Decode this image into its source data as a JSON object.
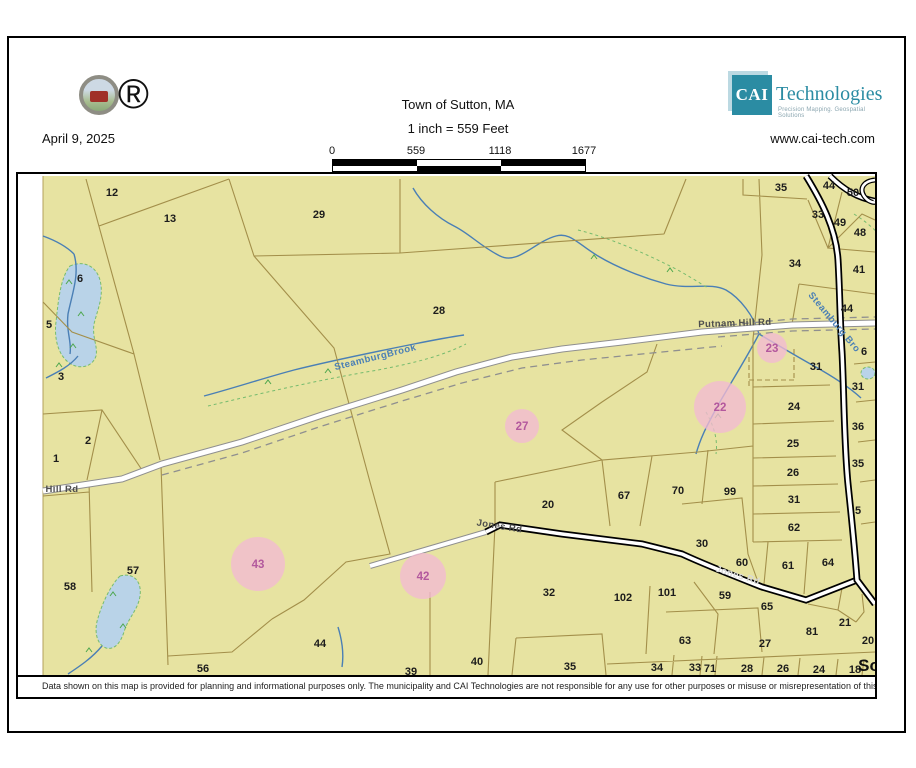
{
  "header": {
    "date": "April 9, 2025",
    "registered_mark": "®",
    "title": "Town of Sutton, MA",
    "scale_text": "1 inch = 559 Feet",
    "scale_ticks": [
      "0",
      "559",
      "1118",
      "1677"
    ],
    "brand": {
      "abbr": "CAI",
      "name": "Technologies",
      "tagline": "Precision Mapping. Geospatial Solutions",
      "website": "www.cai-tech.com"
    }
  },
  "map": {
    "disclaimer": "Data shown on this map is provided for planning and informational purposes only. The municipality and CAI Technologies are not responsible for any use for other purposes or misuse or misrepresentation of this map.",
    "colors": {
      "land": "#e7e3a1",
      "parcel_line": "#a38f4a",
      "water_fill": "#b9d3e8",
      "water_line": "#4a7fb5",
      "wetland_green": "#76bb6e",
      "highlight_pink": "#f2bad4",
      "highlight_text": "#b3589d",
      "brand_teal": "#2b8ca3"
    },
    "parcel_labels": [
      {
        "n": "12",
        "x": 94,
        "y": 18
      },
      {
        "n": "13",
        "x": 152,
        "y": 44
      },
      {
        "n": "29",
        "x": 301,
        "y": 40
      },
      {
        "n": "28",
        "x": 421,
        "y": 136
      },
      {
        "n": "6",
        "x": 62,
        "y": 104
      },
      {
        "n": "5",
        "x": 31,
        "y": 150
      },
      {
        "n": "3",
        "x": 43,
        "y": 202
      },
      {
        "n": "2",
        "x": 70,
        "y": 266
      },
      {
        "n": "1",
        "x": 38,
        "y": 284
      },
      {
        "n": "58",
        "x": 52,
        "y": 412
      },
      {
        "n": "57",
        "x": 115,
        "y": 396
      },
      {
        "n": "56",
        "x": 185,
        "y": 494
      },
      {
        "n": "44",
        "x": 302,
        "y": 469
      },
      {
        "n": "39",
        "x": 393,
        "y": 497
      },
      {
        "n": "40",
        "x": 459,
        "y": 487
      },
      {
        "n": "35",
        "x": 552,
        "y": 492
      },
      {
        "n": "32",
        "x": 531,
        "y": 418
      },
      {
        "n": "20",
        "x": 530,
        "y": 330
      },
      {
        "n": "67",
        "x": 606,
        "y": 321
      },
      {
        "n": "70",
        "x": 660,
        "y": 316
      },
      {
        "n": "99",
        "x": 712,
        "y": 317
      },
      {
        "n": "30",
        "x": 684,
        "y": 369
      },
      {
        "n": "60",
        "x": 724,
        "y": 388
      },
      {
        "n": "61",
        "x": 770,
        "y": 391
      },
      {
        "n": "64",
        "x": 810,
        "y": 388
      },
      {
        "n": "102",
        "x": 605,
        "y": 423
      },
      {
        "n": "101",
        "x": 649,
        "y": 418
      },
      {
        "n": "59",
        "x": 707,
        "y": 421
      },
      {
        "n": "65",
        "x": 749,
        "y": 432
      },
      {
        "n": "63",
        "x": 667,
        "y": 466
      },
      {
        "n": "27",
        "x": 747,
        "y": 469
      },
      {
        "n": "81",
        "x": 794,
        "y": 457
      },
      {
        "n": "21",
        "x": 827,
        "y": 448
      },
      {
        "n": "20",
        "x": 850,
        "y": 466
      },
      {
        "n": "34",
        "x": 639,
        "y": 493
      },
      {
        "n": "33",
        "x": 677,
        "y": 493
      },
      {
        "n": "71",
        "x": 692,
        "y": 494
      },
      {
        "n": "28",
        "x": 729,
        "y": 494
      },
      {
        "n": "26",
        "x": 765,
        "y": 494
      },
      {
        "n": "24",
        "x": 801,
        "y": 495
      },
      {
        "n": "18",
        "x": 837,
        "y": 495
      },
      {
        "n": "35",
        "x": 763,
        "y": 13
      },
      {
        "n": "44",
        "x": 811,
        "y": 11
      },
      {
        "n": "50",
        "x": 835,
        "y": 18
      },
      {
        "n": "33",
        "x": 800,
        "y": 40
      },
      {
        "n": "49",
        "x": 822,
        "y": 48
      },
      {
        "n": "48",
        "x": 842,
        "y": 58
      },
      {
        "n": "34",
        "x": 777,
        "y": 89
      },
      {
        "n": "41",
        "x": 841,
        "y": 95
      },
      {
        "n": "44",
        "x": 829,
        "y": 134
      },
      {
        "n": "31",
        "x": 798,
        "y": 192
      },
      {
        "n": "6",
        "x": 846,
        "y": 177
      },
      {
        "n": "31",
        "x": 840,
        "y": 212
      },
      {
        "n": "24",
        "x": 776,
        "y": 232
      },
      {
        "n": "36",
        "x": 840,
        "y": 252
      },
      {
        "n": "25",
        "x": 775,
        "y": 269
      },
      {
        "n": "35",
        "x": 840,
        "y": 289
      },
      {
        "n": "26",
        "x": 775,
        "y": 298
      },
      {
        "n": "31",
        "x": 776,
        "y": 325
      },
      {
        "n": "5",
        "x": 840,
        "y": 336
      },
      {
        "n": "62",
        "x": 776,
        "y": 353
      }
    ],
    "highlight_circles": [
      {
        "n": "27",
        "x": 504,
        "y": 252,
        "r": 17
      },
      {
        "n": "23",
        "x": 754,
        "y": 174,
        "r": 15
      },
      {
        "n": "22",
        "x": 702,
        "y": 233,
        "r": 26
      },
      {
        "n": "43",
        "x": 240,
        "y": 390,
        "r": 27
      },
      {
        "n": "42",
        "x": 405,
        "y": 402,
        "r": 23
      }
    ],
    "road_labels": [
      {
        "t": "Hill Rd",
        "x": 44,
        "y": 318,
        "r": 0,
        "s": "gray"
      },
      {
        "t": "Putnam Hill Rd",
        "x": 717,
        "y": 152,
        "r": -2,
        "s": "gray"
      },
      {
        "t": "Jones Rd",
        "x": 481,
        "y": 355,
        "r": 9,
        "s": "gray"
      },
      {
        "t": "Jones Rd",
        "x": 719,
        "y": 404,
        "r": 17,
        "s": "light"
      }
    ],
    "water_labels": [
      {
        "t": "SteamburgBrook",
        "x": 358,
        "y": 186,
        "r": -14
      },
      {
        "t": "Steamburg Bro",
        "x": 814,
        "y": 150,
        "r": 50
      }
    ],
    "edge_label": {
      "t": "So",
      "x": 851,
      "y": 497
    }
  }
}
